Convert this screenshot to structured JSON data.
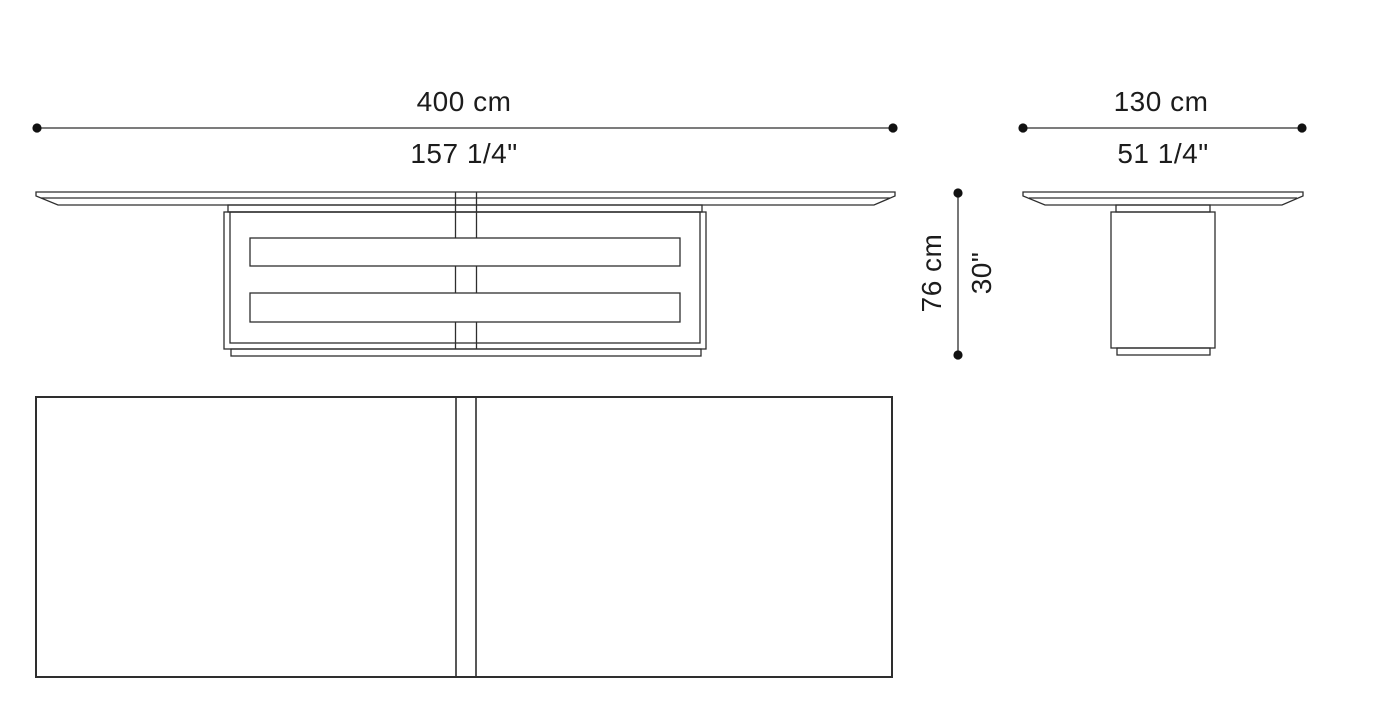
{
  "drawing": {
    "type": "furniture-dimension-drawing",
    "background_color": "#ffffff",
    "line_color": "#2e2e2e",
    "marker_color": "#111111"
  },
  "views": {
    "front": "front elevation",
    "side": "side elevation",
    "plan": "top plan"
  },
  "dimensions": {
    "width": {
      "metric": "400 cm",
      "imperial": "157 1/4\""
    },
    "depth": {
      "metric": "130 cm",
      "imperial": "51 1/4\""
    },
    "height": {
      "metric": "76 cm",
      "imperial": "30\""
    }
  }
}
